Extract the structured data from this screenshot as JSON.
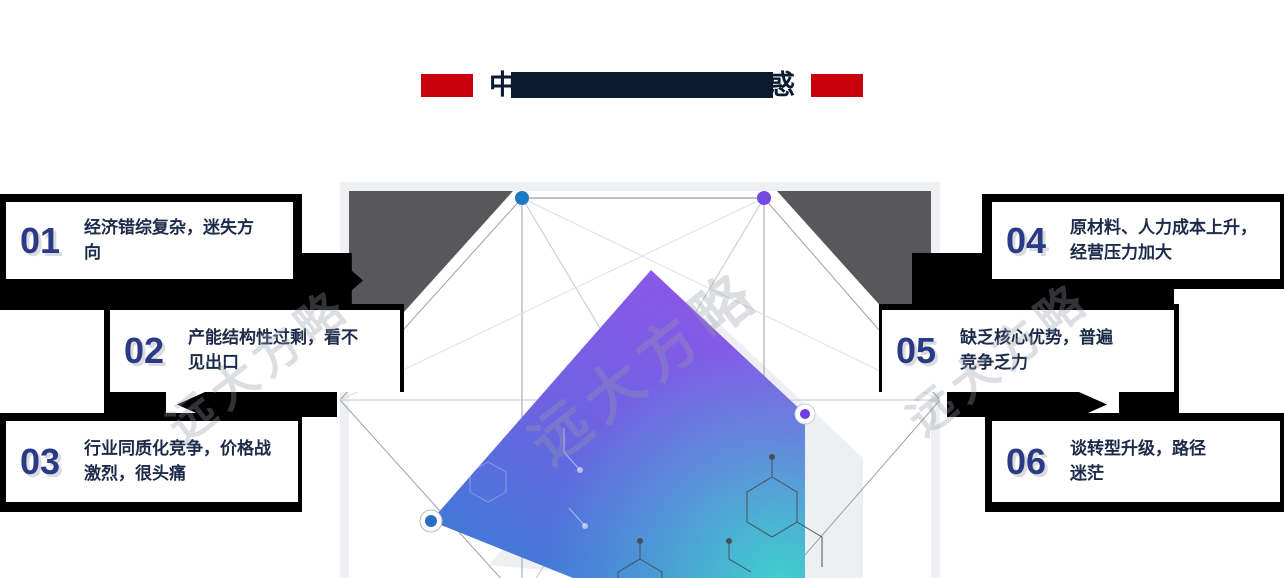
{
  "title": {
    "first_char": "中",
    "last_char": "惑"
  },
  "watermark": {
    "text": "远大方略"
  },
  "cards": [
    {
      "num": "01",
      "text": "经济错综复杂，迷失方向"
    },
    {
      "num": "02",
      "text": "产能结构性过剩，看不见出口"
    },
    {
      "num": "03",
      "text": "行业同质化竞争，价格战激烈，很头痛"
    },
    {
      "num": "04",
      "text": "原材料、人力成本上升，经营压力加大"
    },
    {
      "num": "05",
      "text": "缺乏核心优势，普遍竞争乏力"
    },
    {
      "num": "06",
      "text": "谈转型升级，路径迷茫"
    }
  ],
  "diagram": {
    "vertex_markers": [
      "blue-dot",
      "purple-dot",
      "purple-ring-dot",
      "blue-ring-dot"
    ]
  },
  "colors": {
    "accent_red": "#c7000b",
    "title_navy": "#0c1a30",
    "card_number_indigo": "#2b3a85",
    "card_text_navy": "#1c2b4a",
    "shadow_black": "#000000",
    "dark_corner_gray": "#58585a",
    "gradient_purple": "#8a57e9",
    "gradient_blue": "#3f7ad7",
    "gradient_teal": "#3fd4cd",
    "dot_blue": "#1d79c4",
    "dot_purple": "#7448e2"
  }
}
